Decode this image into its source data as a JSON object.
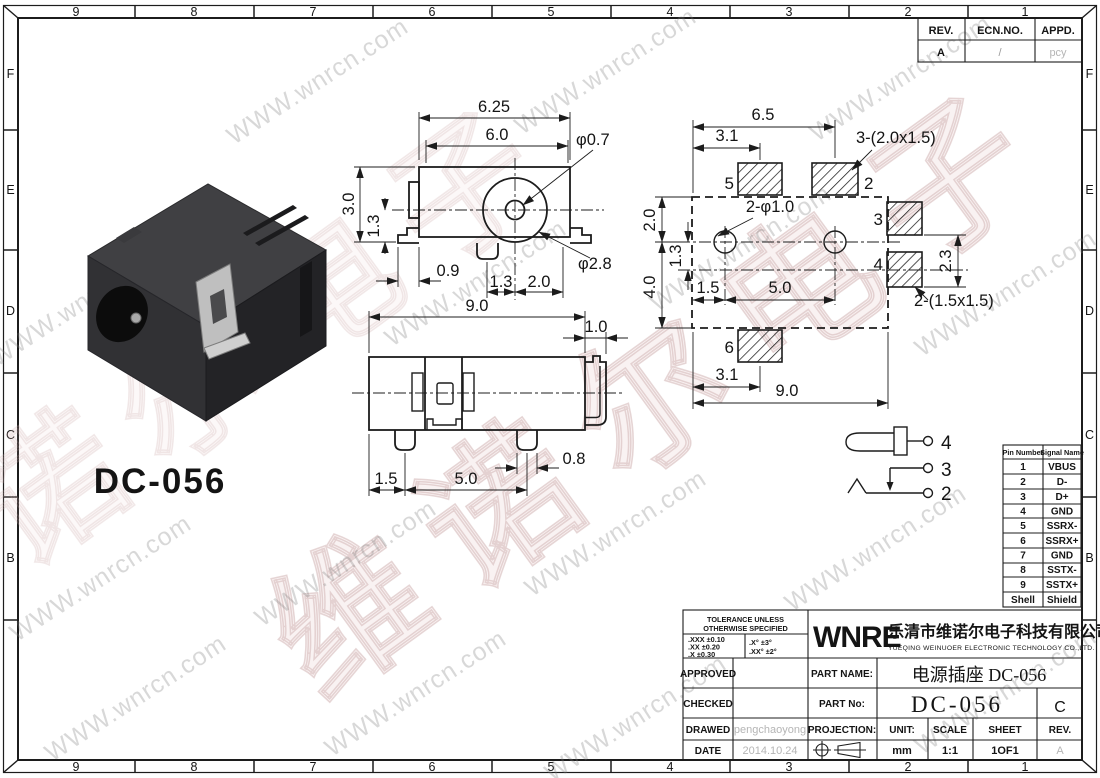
{
  "border": {
    "top_zones": [
      "9",
      "8",
      "7",
      "6",
      "5",
      "4",
      "3",
      "2",
      "1"
    ],
    "bottom_zones": [
      "9",
      "8",
      "7",
      "6",
      "5",
      "4",
      "3",
      "2",
      "1"
    ],
    "left_zones": [
      "F",
      "E",
      "D",
      "C",
      "B"
    ],
    "right_zones": [
      "F",
      "E",
      "D",
      "C",
      "B"
    ]
  },
  "rev_table": {
    "col_rev": "REV.",
    "col_ecn": "ECN.NO.",
    "col_appd": "APPD.",
    "rev": "A",
    "ecn": "/",
    "appd": "pcy"
  },
  "watermark": {
    "site": "WWW.wnrcn.com",
    "brand": "维诺尔电子"
  },
  "part_label": "DC-056",
  "front_view": {
    "dim_w_outer": "6.25",
    "dim_w_inner": "6.0",
    "note_pin_dia": "φ0.7",
    "dim_height": "3.0",
    "dim_center": "1.3",
    "dim_foot": "0.9",
    "dim_peg_off": "1.3",
    "dim_hole_off": "2.0",
    "note_barrel_dia": "φ2.8"
  },
  "side_view": {
    "dim_width": "9.0",
    "dim_foot": "1.0",
    "dim_peg1": "1.5",
    "dim_pitch": "5.0",
    "dim_peg_w": "0.8"
  },
  "layout_view": {
    "dim_pad_span": "6.5",
    "dim_pad5_off": "3.1",
    "note_pads_top": "3-(2.0x1.5)",
    "pad5": "5",
    "pad2": "2",
    "note_holes": "2-φ1.0",
    "pad3": "3",
    "pad4": "4",
    "dim_top": "2.0",
    "dim_mid": "1.3",
    "dim_height": "4.0",
    "dim_hole1": "1.5",
    "dim_hole_pitch": "5.0",
    "dim_side": "2.3",
    "note_pads_side": "2-(1.5x1.5)",
    "pad6": "6",
    "dim_pad6_off": "3.1",
    "dim_width": "9.0"
  },
  "schematic": {
    "pin4": "4",
    "pin3": "3",
    "pin2": "2"
  },
  "pin_table": {
    "headers": [
      "Pin Number",
      "Signal Name"
    ],
    "rows": [
      [
        "1",
        "VBUS"
      ],
      [
        "2",
        "D-"
      ],
      [
        "3",
        "D+"
      ],
      [
        "4",
        "GND"
      ],
      [
        "5",
        "SSRX-"
      ],
      [
        "6",
        "SSRX+"
      ],
      [
        "7",
        "GND"
      ],
      [
        "8",
        "SSTX-"
      ],
      [
        "9",
        "SSTX+"
      ],
      [
        "Shell",
        "Shield"
      ]
    ]
  },
  "title_block": {
    "tol_title1": "TOLERANCE UNLESS",
    "tol_title2": "OTHERWISE SPECIFIED",
    "tol_l1": ".XXX ±0.10",
    "tol_l2": ".XX ±0.20",
    "tol_l3": ".X ±0.30",
    "tol_r1": ".X° ±3°",
    "tol_r2": ".XX° ±2°",
    "logo": "WNRE",
    "company_cn": "乐清市维诺尔电子科技有限公司",
    "company_en": "YUEQING WEINUOER ELECTRONIC TECHNOLOGY CO.,LTD.",
    "approved": "APPROVED",
    "checked": "CHECKED",
    "drawed": "DRAWED",
    "date": "DATE",
    "drawed_by": "pengchaoyong",
    "date_value": "2014.10.24",
    "part_name_label": "PART NAME:",
    "part_name": "电源插座 DC-056",
    "part_no_label": "PART No:",
    "part_no": "DC-056",
    "rev_letter": "C",
    "projection": "PROJECTION:",
    "unit_label": "UNIT:",
    "unit": "mm",
    "scale_label": "SCALE",
    "scale": "1:1",
    "sheet_label": "SHEET",
    "sheet": "1OF1",
    "rev_label": "REV.",
    "rev": "A"
  }
}
